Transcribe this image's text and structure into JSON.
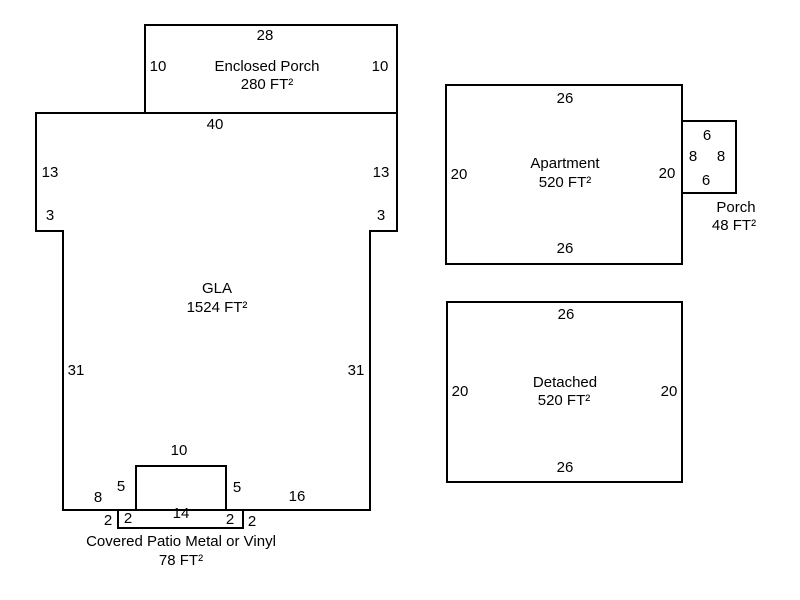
{
  "colors": {
    "line": "#000000",
    "text": "#000000",
    "background": "#ffffff"
  },
  "shapes": {
    "enclosed_porch": {
      "title": "Enclosed Porch",
      "area": "280 FT²",
      "dim_top": "28",
      "dim_left": "10",
      "dim_right": "10",
      "dim_bottom": "40"
    },
    "gla": {
      "title": "GLA",
      "area": "1524 FT²",
      "dim_left_upper": "13",
      "dim_right_upper": "13",
      "dim_left_step": "3",
      "dim_right_step": "3",
      "dim_left_lower": "31",
      "dim_right_lower": "31",
      "dim_bottom_left": "8",
      "dim_bottom_right": "16"
    },
    "covered_patio": {
      "title": "Covered Patio Metal or Vinyl",
      "area": "78 FT²",
      "dim_top": "10",
      "dim_left_upper": "5",
      "dim_right_upper": "5",
      "dim_bottom": "14",
      "dim_left_outer": "2",
      "dim_left_inner": "2",
      "dim_right_inner": "2",
      "dim_right_outer": "2"
    },
    "apartment": {
      "title": "Apartment",
      "area": "520 FT²",
      "dim_top": "26",
      "dim_left": "20",
      "dim_right": "20",
      "dim_bottom": "26"
    },
    "apartment_porch": {
      "title": "Porch",
      "area": "48 FT²",
      "dim_top": "6",
      "dim_left": "8",
      "dim_right": "8",
      "dim_bottom": "6"
    },
    "detached": {
      "title": "Detached",
      "area": "520 FT²",
      "dim_top": "26",
      "dim_left": "20",
      "dim_right": "20",
      "dim_bottom": "26"
    }
  }
}
